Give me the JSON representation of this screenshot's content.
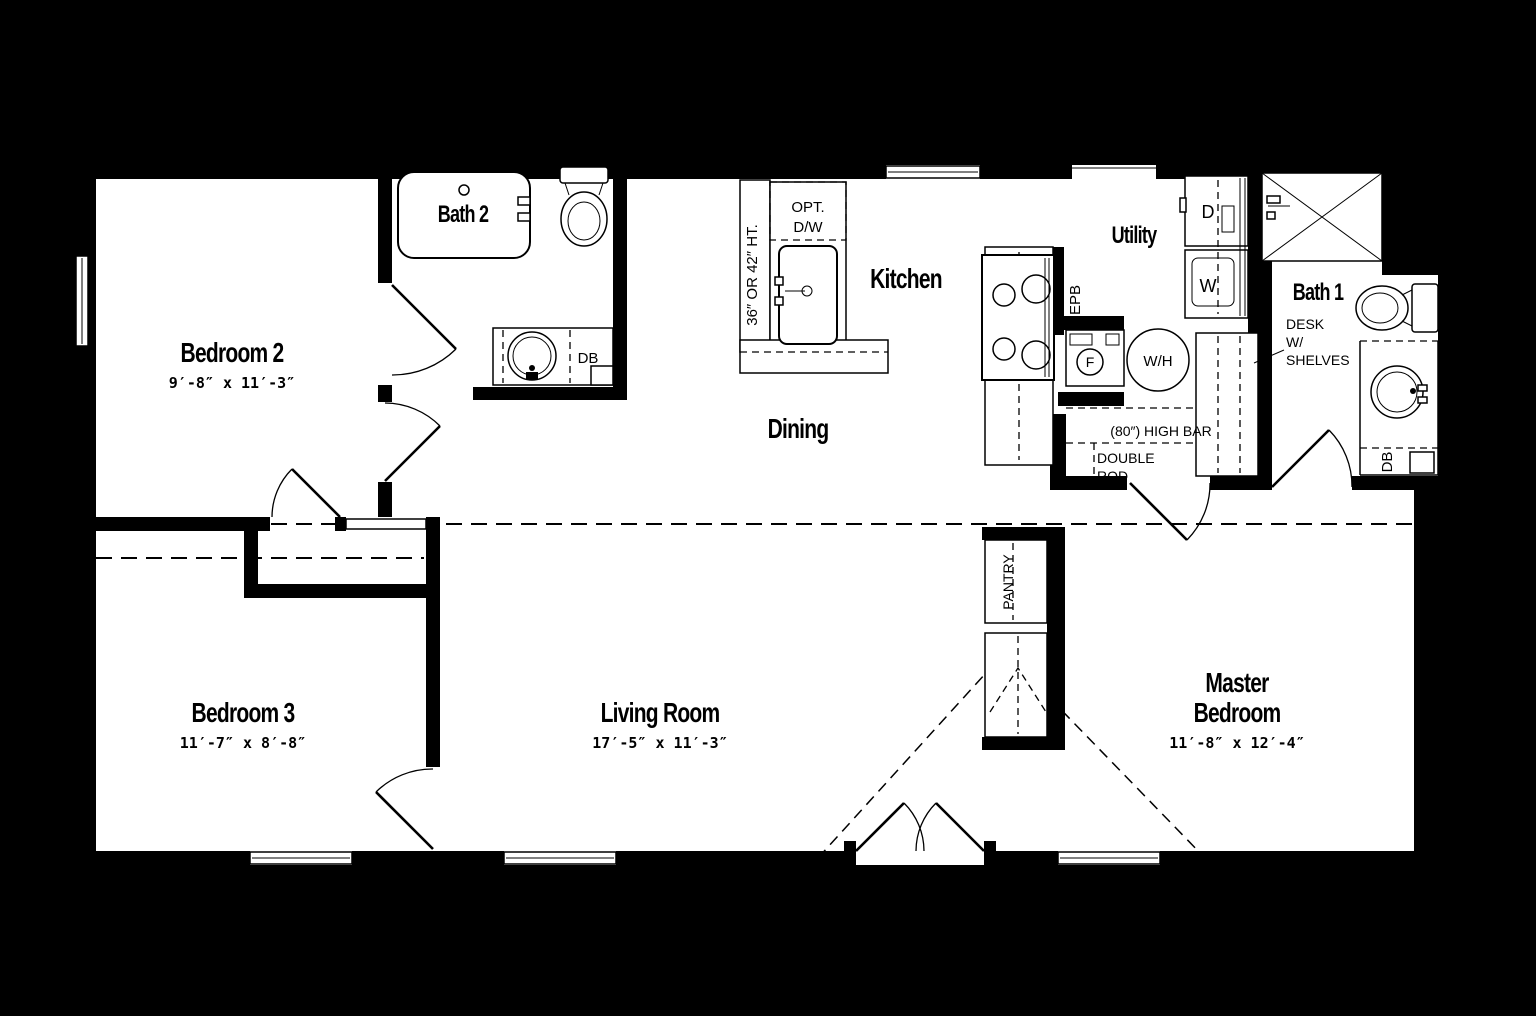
{
  "plan": {
    "type": "floor-plan",
    "colors": {
      "background": "#000000",
      "walls": "#000000",
      "floor": "#ffffff"
    }
  },
  "rooms": [
    {
      "id": "bedroom2",
      "name": "Bedroom 2",
      "dims": "9′-8″ x 11′-3″"
    },
    {
      "id": "bedroom3",
      "name": "Bedroom 3",
      "dims": "11′-7″ x 8′-8″"
    },
    {
      "id": "living",
      "name": "Living Room",
      "dims": "17′-5″ x 11′-3″"
    },
    {
      "id": "master",
      "line1": "Master",
      "line2": "Bedroom",
      "dims": "11′-8″ x 12′-4″"
    },
    {
      "id": "dining",
      "name": "Dining"
    },
    {
      "id": "kitchen",
      "name": "Kitchen"
    },
    {
      "id": "utility",
      "name": "Utility"
    },
    {
      "id": "bath2",
      "name": "Bath 2"
    },
    {
      "id": "bath1",
      "name": "Bath 1"
    }
  ],
  "annotations": {
    "counter_height": "36″ OR 42″ HT.",
    "opt_dw_line1": "OPT.",
    "opt_dw_line2": "D/W",
    "epb": "EPB",
    "dryer": "D",
    "washer": "W",
    "furnace": "F",
    "water_heater": "W/H",
    "high_bar": "(80″)  HIGH  BAR",
    "double_rod_line1": "DOUBLE",
    "double_rod_line2": "ROD",
    "desk_line1": "DESK",
    "desk_line2": "W/",
    "desk_line3": "SHELVES",
    "pantry": "PANTRY",
    "db_bath2": "DB",
    "db_bath1": "DB"
  }
}
